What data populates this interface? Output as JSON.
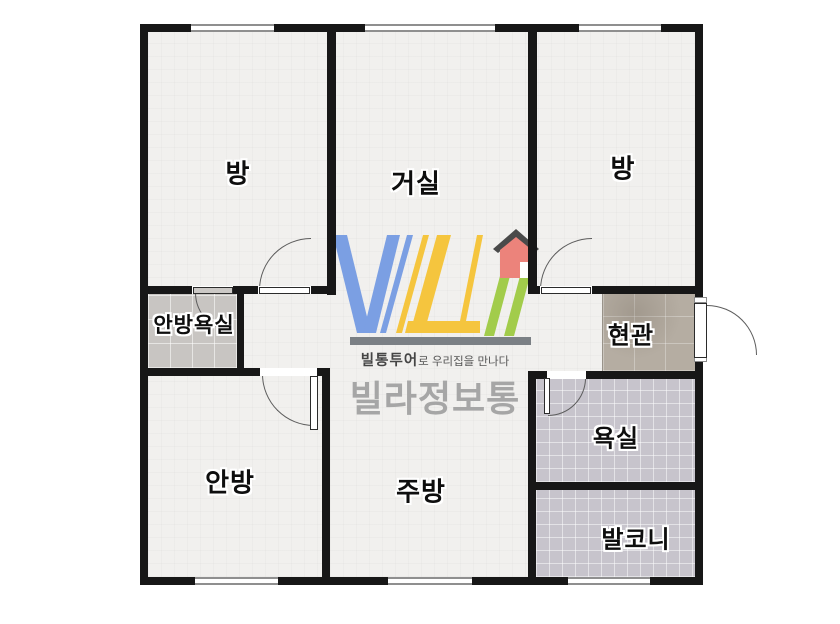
{
  "plan": {
    "type": "apartment-floor-plan",
    "rooms": [
      {
        "id": "room-top-left",
        "label": "방"
      },
      {
        "id": "living-room",
        "label": "거실"
      },
      {
        "id": "room-top-right",
        "label": "방"
      },
      {
        "id": "master-bathroom",
        "label": "안방욕실"
      },
      {
        "id": "entrance",
        "label": "현관"
      },
      {
        "id": "master-bedroom",
        "label": "안방"
      },
      {
        "id": "kitchen",
        "label": "주방"
      },
      {
        "id": "bathroom",
        "label": "욕실"
      },
      {
        "id": "balcony",
        "label": "발코니"
      }
    ]
  },
  "watermark": {
    "logo_text": "VILI",
    "tagline_bold": "빌통투어",
    "tagline_rest": "로 우리집을 만나다",
    "brand": "빌라정보통",
    "logo_colors": {
      "blue": "#7b9fe3",
      "yellow": "#f5c53e",
      "green": "#a2cc4b",
      "red": "#ec837b",
      "roof": "#4a4a4a",
      "bar": "#7b8085"
    }
  },
  "palette": {
    "wall": "#171717",
    "floor": "#f1f0ee",
    "master_bath_tile": "#c8c5c2",
    "entry_tile": "#b5ada2",
    "bath_tile": "#c7c4cc",
    "background": "#ffffff"
  }
}
